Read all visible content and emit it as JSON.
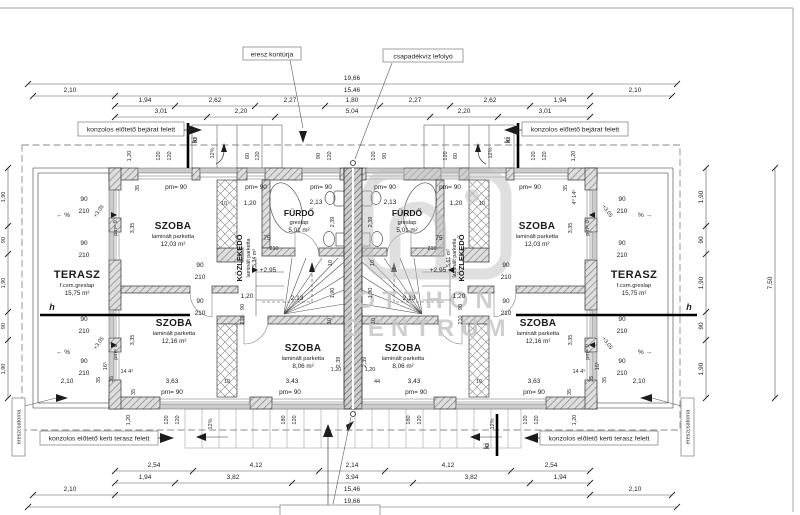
{
  "annotations": {
    "eaves_contour": "eresz kontúrja",
    "rain_downpipe": "csapadékvíz lefolyó",
    "canopy_entrance": "konzolos előtető bejárat felett",
    "canopy_garden": "konzolos előtető kerti terasz felett",
    "gutter": "ereszcsatorna",
    "exit_mark": "ki",
    "section_mark": "h",
    "slope_12": "12%",
    "slope_left": "← %",
    "slope_right": "% →",
    "level_295": "+2,95",
    "level_305": "+3,05",
    "pm0": "pm= 0",
    "pm90": "pm= 90"
  },
  "watermark": {
    "line1": "OTTHON",
    "line2": "CENTRUM"
  },
  "rooms": {
    "left": {
      "szoba_top": {
        "name": "SZOBA",
        "floor": "laminált parketta",
        "area": "12,03 m²"
      },
      "furdo": {
        "name": "FÜRDŐ",
        "floor": "greslap",
        "area": "5,01 m²"
      },
      "kozlekedo": {
        "name": "KÖZLEKEDŐ",
        "floor": "laminált parketta",
        "area": "5,34 m²"
      },
      "szoba_mid": {
        "name": "SZOBA",
        "floor": "laminált parketta",
        "area": "12,16 m²"
      },
      "szoba_small": {
        "name": "SZOBA",
        "floor": "laminált parketta",
        "area": "8,06 m²"
      },
      "terasz": {
        "name": "TERASZ",
        "floor": "f.csm.greslap",
        "area": "15,75 m²"
      }
    },
    "right": {
      "szoba_top": {
        "name": "SZOBA",
        "floor": "laminált parketta",
        "area": "12,03 m²"
      },
      "furdo": {
        "name": "FÜRDŐ",
        "floor": "greslap",
        "area": "5,01 m²"
      },
      "kozlekedo": {
        "name": "KÖZLEKEDŐ",
        "floor": "laminált parketta",
        "area": "5,61 m²"
      },
      "szoba_mid": {
        "name": "SZOBA",
        "floor": "laminált parketta",
        "area": "12,16 m²"
      },
      "szoba_small": {
        "name": "SZOBA",
        "floor": "laminált parketta",
        "area": "8,06 m²"
      },
      "terasz": {
        "name": "TERASZ",
        "floor": "f.csm.greslap",
        "area": "15,75 m²"
      }
    }
  },
  "dims": {
    "top": {
      "total": "19,66",
      "inner": "15,46",
      "left_end": "2,10",
      "right_end": "2,10",
      "row3": [
        "1,94",
        "2,62",
        "2,27",
        "1,80",
        "2,27",
        "2,62",
        "1,94"
      ],
      "row4": [
        "3,01",
        "2,20",
        "5,04",
        "2,20",
        "3,01"
      ]
    },
    "bottom": {
      "row1": [
        "2,54",
        "4,12",
        "2,14",
        "4,12",
        "2,54"
      ],
      "row2": [
        "1,94",
        "3,82",
        "3,94",
        "3,82",
        "1,94"
      ],
      "inner": "15,46",
      "total": "19,66",
      "left_end": "2,10",
      "right_end": "2,10"
    },
    "side": {
      "segs": [
        "1,90",
        "90",
        "1,90",
        "90",
        "1,90"
      ],
      "total": "7,50"
    },
    "marks": {
      "n90": "90",
      "n210": "210",
      "n35": "35",
      "n10": "10",
      "n75": "75",
      "n120": "120",
      "n180": "180",
      "n60": "60",
      "n1_20": "1,20",
      "n2_13": "2,13",
      "n2_39": "2,39",
      "n1_90": "1,90",
      "n3_35": "3,35",
      "n3_43": "3,43",
      "n3_63": "3,63",
      "n44": "44",
      "n2_10": "2,10",
      "n16": "16⁵",
      "n14": "14 4⁵",
      "n4_14": "4⁰ 14⁵"
    }
  }
}
